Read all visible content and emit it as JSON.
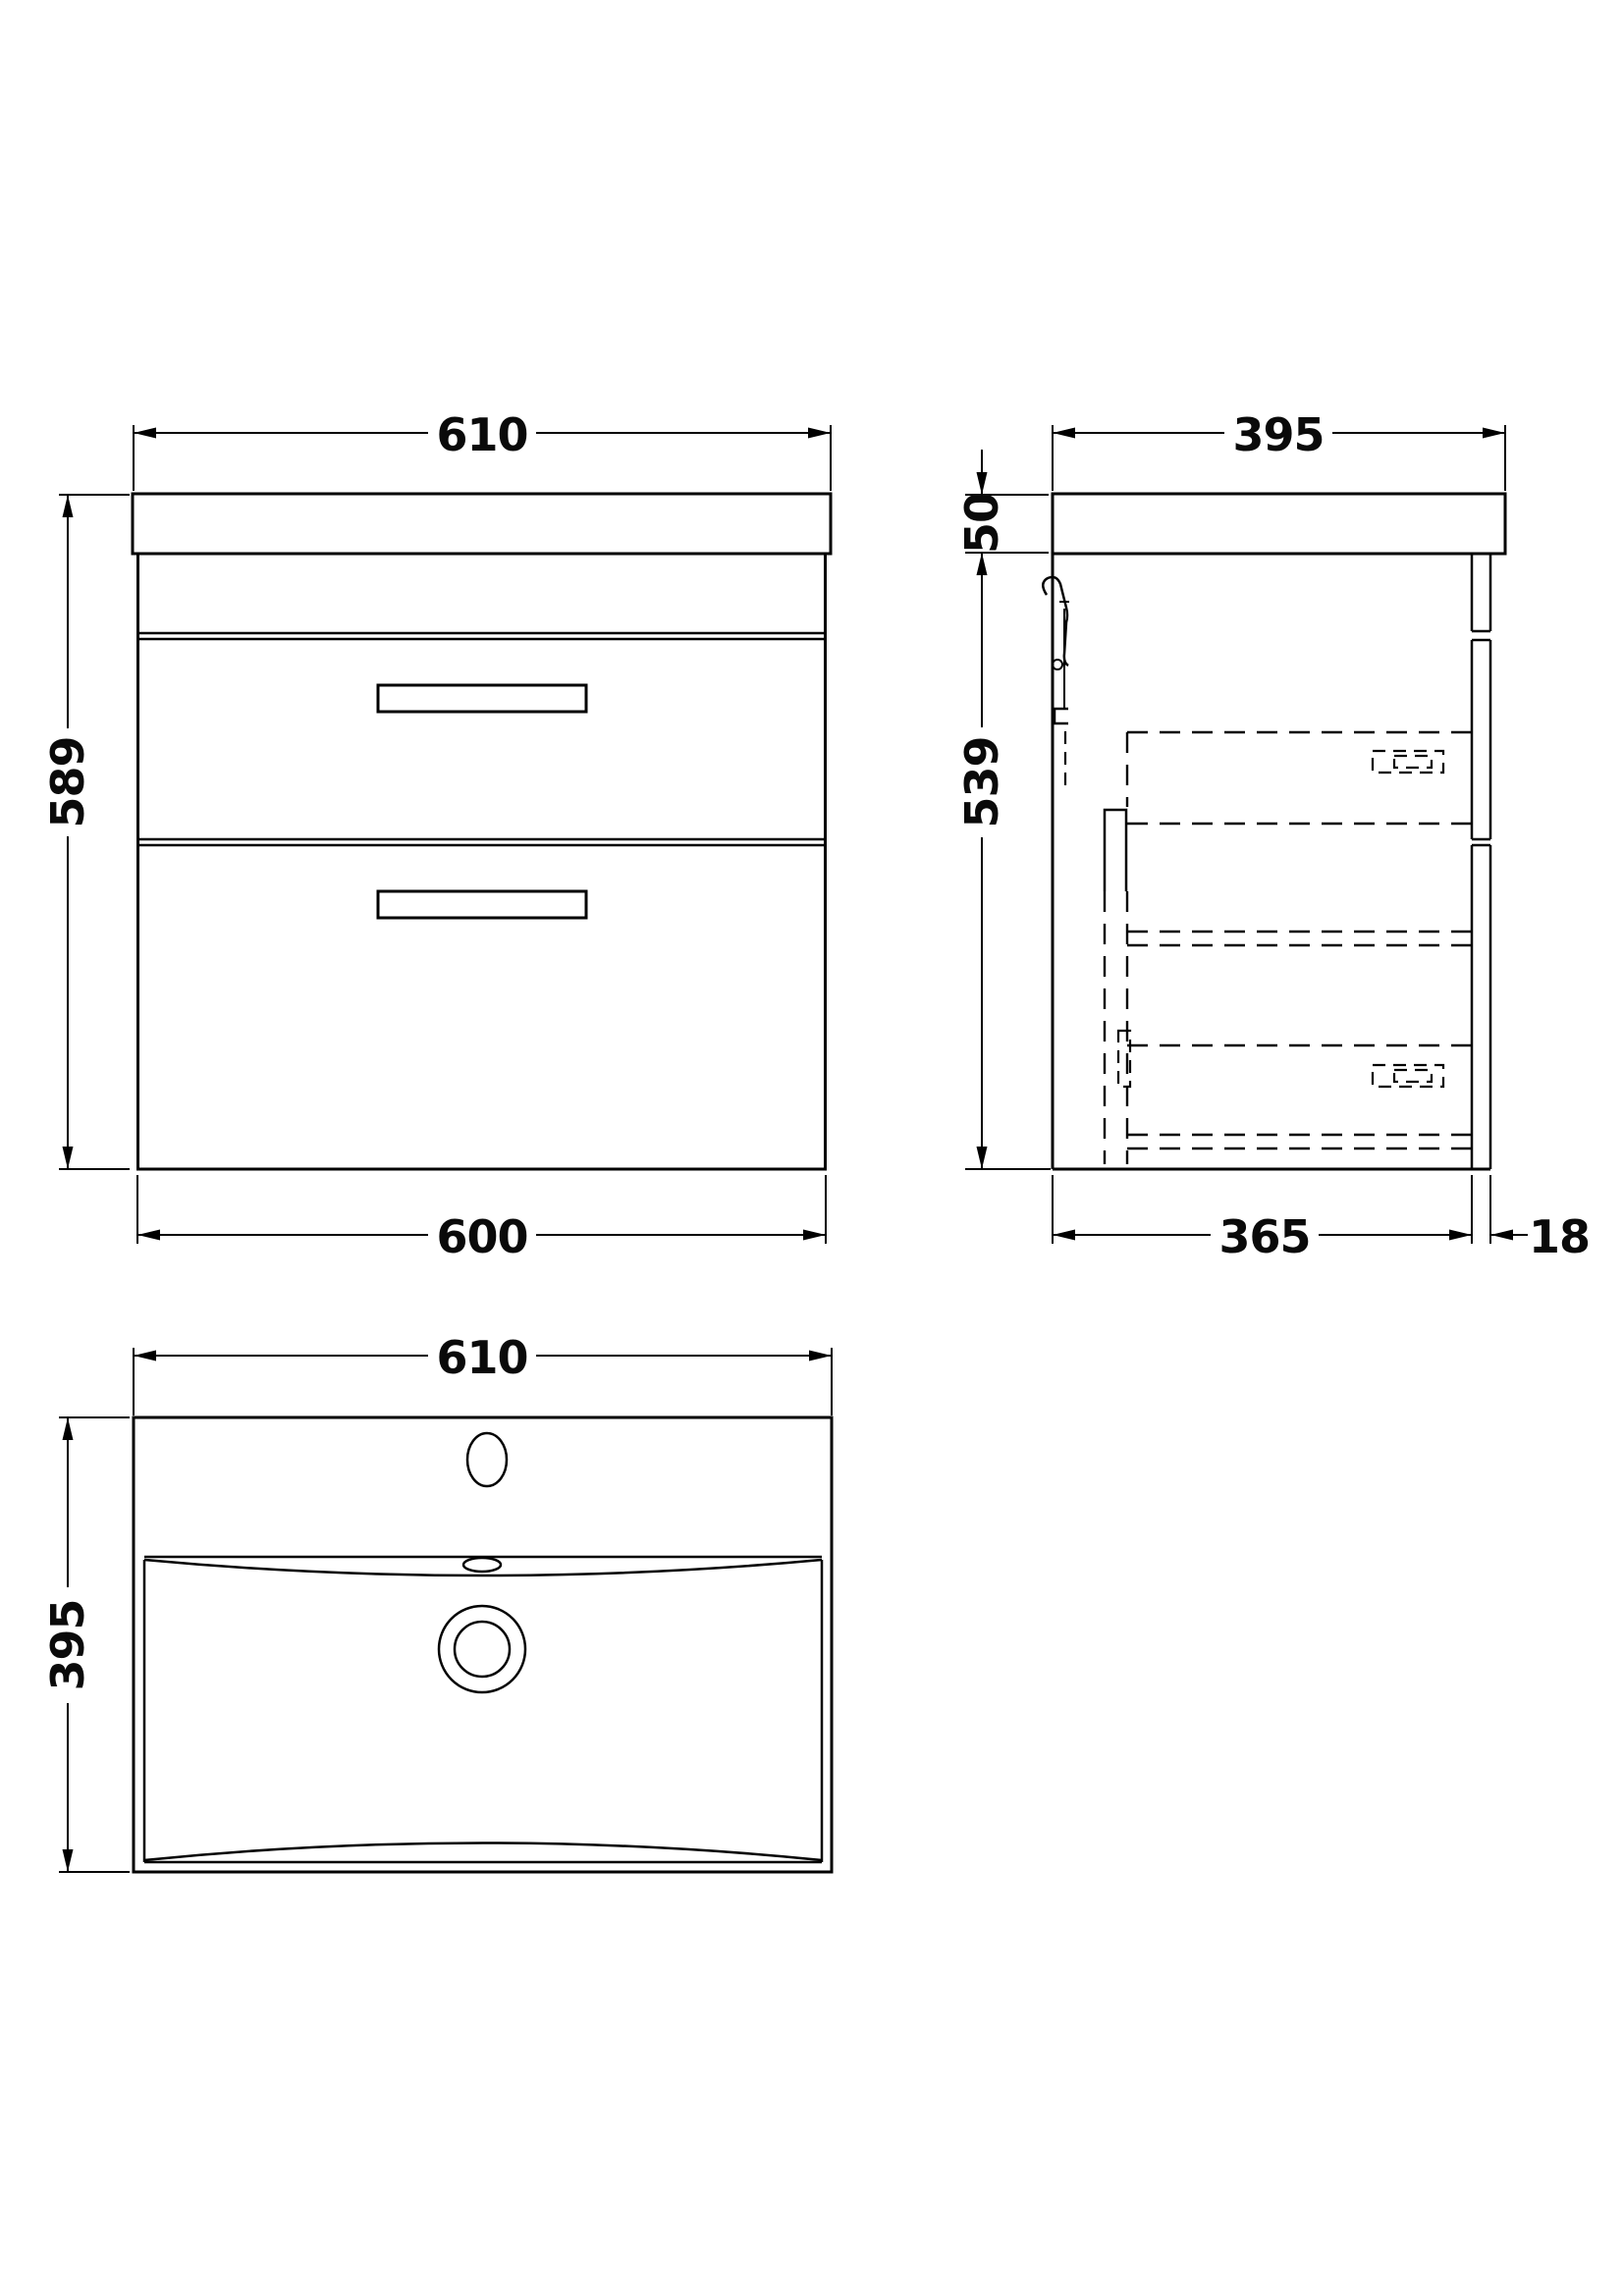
{
  "page": {
    "background_color": "#ffffff",
    "line_color": "#000000"
  },
  "drawing": {
    "kind": "technical dimension drawing",
    "subject": "wall-hung two-drawer basin vanity unit",
    "views": {
      "front": {
        "name": "front-elevation",
        "width_top_mm": "610",
        "height_mm": "589",
        "width_bottom_mm": "600"
      },
      "side": {
        "name": "side-elevation",
        "depth_top_mm": "395",
        "worktop_height_mm": "50",
        "cabinet_height_mm": "539",
        "depth_bottom_mm": "365",
        "front_panel_mm": "18"
      },
      "plan": {
        "name": "basin-plan",
        "width_mm": "610",
        "depth_mm": "395"
      }
    }
  }
}
